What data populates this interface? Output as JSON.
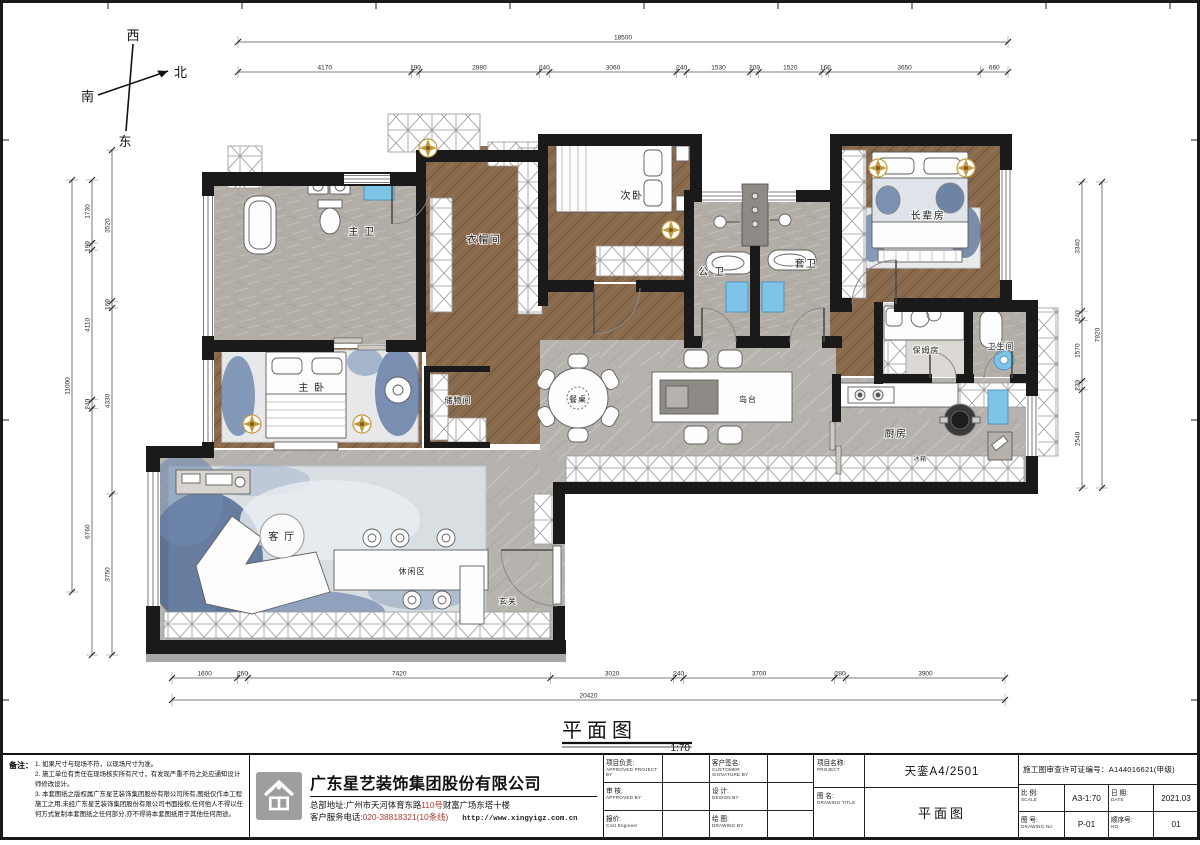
{
  "sheet": {
    "drawing_title": "平面图",
    "drawing_scale": "1:70"
  },
  "compass": {
    "west": "西",
    "north": "北",
    "south": "南",
    "east": "东"
  },
  "dims": {
    "top_overall": [
      "18500"
    ],
    "top_segments": [
      "4170",
      "190",
      "2880",
      "240",
      "3060",
      "240",
      "1530",
      "200",
      "1520",
      "160",
      "3650",
      "660"
    ],
    "left_overall": [
      "11000"
    ],
    "left_mid": [
      "1730",
      "190",
      "4110",
      "240",
      "6760"
    ],
    "left_inner": [
      "3520",
      "160",
      "4330",
      "3750"
    ],
    "right_overall": [
      "7920"
    ],
    "right_segments": [
      "3340",
      "240",
      "1570",
      "230",
      "2540"
    ],
    "bottom_overall": [
      "20420"
    ],
    "bottom_segments": [
      "1600",
      "260",
      "7420",
      "3020",
      "240",
      "3700",
      "280",
      "3900"
    ]
  },
  "rooms": {
    "master_bath": "主 卫",
    "cloakroom": "衣帽间",
    "second_bedroom": "次卧",
    "public_bath": "公 卫",
    "ensuite_bath": "套卫",
    "elder_bedroom": "长辈房",
    "nanny_room": "保姆房",
    "toilet": "卫生间",
    "kitchen": "厨房",
    "fridge": "冰箱",
    "master_bedroom": "主 卧",
    "storage": "储物间",
    "dining_table": "餐桌",
    "island": "岛台",
    "living_room": "客 厅",
    "leisure_area": "休闲区",
    "foyer": "玄关"
  },
  "notes": {
    "heading": "备注：",
    "lines": [
      "1. 如果尺寸与现场不符，以现场尺寸为准。",
      "2. 施工单位有责任在现场核实所有尺寸，有发现严重不符之处应通知设计师修改设计。",
      "3. 本套图纸之版权属广东星艺装饰集团股份有限公司所有,图纸仅作本工程施工之用,未经广东星艺装饰集团股份有限公司书面授权,任何他人不得以任何方式复制本套图纸之任何部分,亦不得将本套图纸用于其他任何用途。"
    ]
  },
  "company": {
    "name": "广东星艺装饰集团股份有限公司",
    "address_label": "总部地址:",
    "address_pre": "广州市天河体育东路",
    "address_num": "110号",
    "address_post": "财富广场东塔十楼",
    "phone_label": "客户服务电话:",
    "phone": "020-38818321(10条线)",
    "website": "http://www.xingyigz.com.cn"
  },
  "titleblock": {
    "fields": [
      {
        "label": "项目负责:",
        "sub": "APPROVED PROJECT BY"
      },
      {
        "label": "客户签名:",
        "sub": "CUSTOMER SIGNATURE BY"
      },
      {
        "label": "审 核:",
        "sub": "APPROVED BY"
      },
      {
        "label": "设 计:",
        "sub": "DESIGN BY"
      },
      {
        "label": "报价:",
        "sub": "Cost Engineer"
      },
      {
        "label": "绘 图:",
        "sub": "DRAWING BY"
      }
    ],
    "project_label": "项目名称:",
    "project_sub": "PROJECT",
    "project_value": "天銮A4/2501",
    "drawing_label": "图 名:",
    "drawing_sub": "DRAWING  TITLE",
    "drawing_value": "平面图",
    "permit": "施工图审查许可证编号：A144016621(甲级)",
    "scale_label": "比 例:",
    "scale_sub": "SCALE",
    "scale_value": "A3-1:70",
    "date_label": "日 期:",
    "date_sub": "DATE",
    "date_value": "2021.03",
    "no_label": "图 号:",
    "no_sub": "DRAWING No",
    "no_value": "P-01",
    "seq_label": "顺序号:",
    "seq_sub": "NO.",
    "seq_value": "01"
  },
  "colors": {
    "wall": "#1a1a1a",
    "wood": "#8a6a4c",
    "tile": "#b2ada6",
    "marble": "#b6b3ae",
    "accent_blue": "#7ec3e8",
    "rug_blue": "#3f5c88",
    "gold": "#c49a3c",
    "red": "#b03a2e"
  }
}
